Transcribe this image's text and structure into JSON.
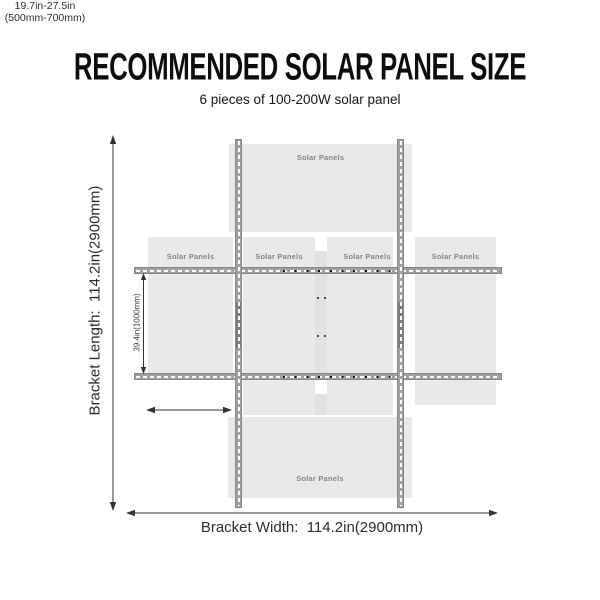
{
  "header": {
    "title": "RECOMMENDED SOLAR PANEL SIZE",
    "subtitle": "6 pieces of 100-200W solar panel"
  },
  "diagram": {
    "bracket_length_label": "Bracket Length:  114.2in(2900mm)",
    "bracket_width_label": "Bracket Width:  114.2in(2900mm)",
    "rail_spacing_label": "39.4in(1000mm)",
    "panel_offset_label": {
      "line1": "19.7in-27.5in",
      "line2": "(500mm-700mm)"
    },
    "panels": [
      {
        "id": "top-center",
        "label": "Solar Panels"
      },
      {
        "id": "middle-left-outer",
        "label": "Solar Panels"
      },
      {
        "id": "middle-left-center",
        "label": "Solar Panels"
      },
      {
        "id": "middle-right-center",
        "label": "Solar Panels"
      },
      {
        "id": "middle-right-outer",
        "label": "Solar Panels"
      },
      {
        "id": "bottom-center",
        "label": "Solar Panels"
      }
    ],
    "colors": {
      "panel_fill": "#e9e9e9",
      "rail_fill": "#a0a0a0",
      "rail_border": "#878787",
      "rail_dark_segment": "#7d7d7d",
      "panel_label_text": "#858585",
      "dimension_line": "#333333",
      "title_text": "#0d0d0d"
    }
  }
}
